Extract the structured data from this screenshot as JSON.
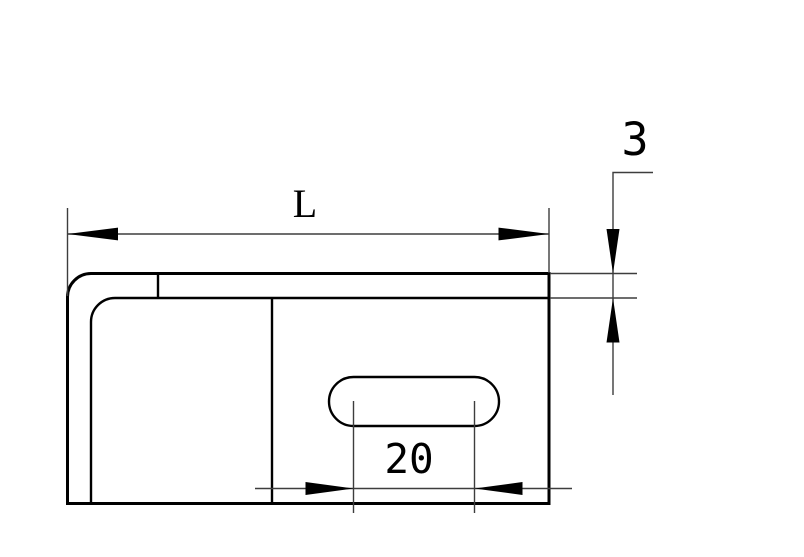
{
  "labels": {
    "length": "L",
    "thickness": "3",
    "slot_spacing": "20"
  },
  "colors": {
    "part_line": "#000000",
    "dimension_line": "#3d3d3d",
    "arrowhead": "#000000",
    "background": "#ffffff"
  }
}
